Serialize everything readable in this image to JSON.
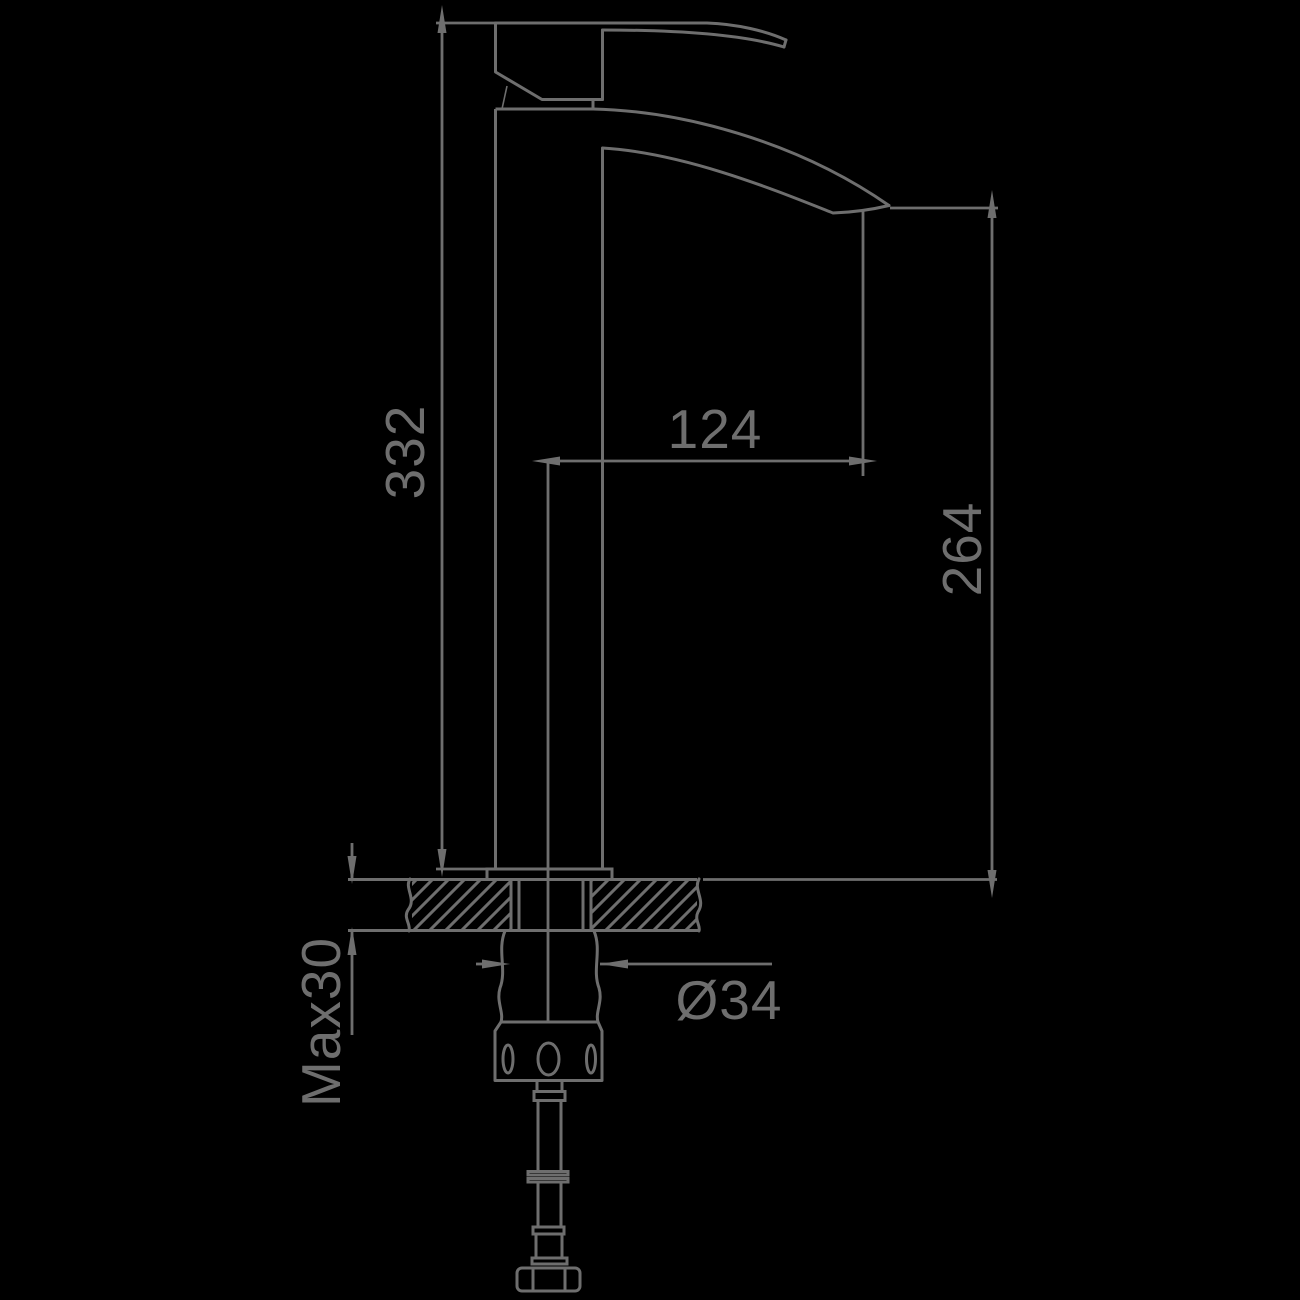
{
  "drawing": {
    "background": "#000000",
    "line_color": "#6e6e6e",
    "dims": {
      "overall_height": "332",
      "spout_reach": "124",
      "spout_height": "264",
      "max_mounting_thickness": "Max30",
      "shank_diameter": "Ø34"
    }
  }
}
